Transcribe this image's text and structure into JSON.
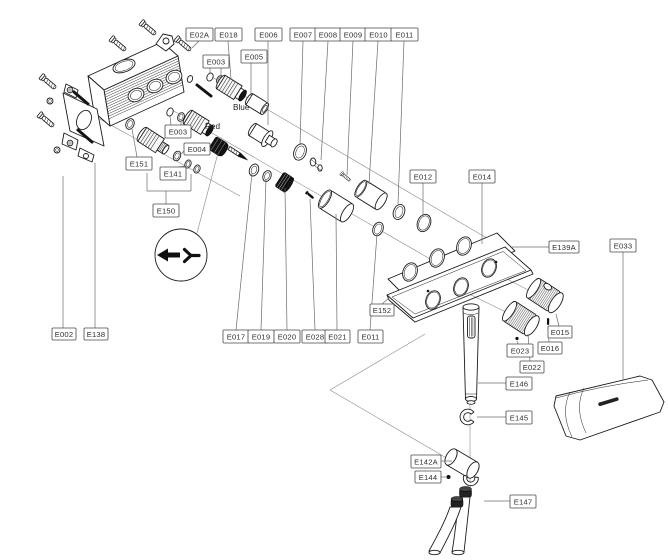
{
  "diagram": {
    "description": "Exploded parts diagram of a thermostatic shower mixer valve assembly",
    "background": "#ffffff",
    "line_color": "#1c1c1c",
    "leader_color": "#6b6b6b",
    "label_border_color": "#4a4a4a",
    "label_text_color": "#2e2e2e",
    "annotations": [
      {
        "text": "Blue",
        "x": 233,
        "y": 110
      },
      {
        "text": "Red",
        "x": 205,
        "y": 129
      }
    ],
    "labels": [
      {
        "text": "E02A",
        "x": 186,
        "y": 28,
        "w": 27,
        "h": 13,
        "leaders": [
          [
            [
              199,
              41
            ],
            [
              192,
              48
            ]
          ]
        ]
      },
      {
        "text": "E018",
        "x": 215,
        "y": 28,
        "w": 27,
        "h": 13,
        "leaders": [
          [
            [
              228,
              41
            ],
            [
              231,
              79
            ]
          ]
        ]
      },
      {
        "text": "E006",
        "x": 255,
        "y": 28,
        "w": 27,
        "h": 13,
        "leaders": [
          [
            [
              268,
              41
            ],
            [
              268,
              125
            ]
          ]
        ]
      },
      {
        "text": "E007",
        "x": 290,
        "y": 28,
        "w": 26,
        "h": 13,
        "leaders": [
          [
            [
              303,
              41
            ],
            [
              300,
              145
            ]
          ]
        ]
      },
      {
        "text": "E008",
        "x": 315,
        "y": 28,
        "w": 26,
        "h": 13,
        "leaders": [
          [
            [
              328,
              41
            ],
            [
              321,
              160
            ]
          ]
        ]
      },
      {
        "text": "E009",
        "x": 340,
        "y": 28,
        "w": 26,
        "h": 13,
        "leaders": [
          [
            [
              353,
              41
            ],
            [
              347,
              175
            ]
          ]
        ]
      },
      {
        "text": "E010",
        "x": 365,
        "y": 28,
        "w": 27,
        "h": 13,
        "leaders": [
          [
            [
              378,
              41
            ],
            [
              369,
              184
            ]
          ]
        ]
      },
      {
        "text": "E011",
        "x": 391,
        "y": 28,
        "w": 27,
        "h": 13,
        "leaders": [
          [
            [
              404,
              41
            ],
            [
              398,
              204
            ]
          ]
        ]
      },
      {
        "text": "E003",
        "x": 203,
        "y": 55,
        "w": 26,
        "h": 13,
        "leaders": [
          [
            [
              210,
              68
            ],
            [
              210,
              74
            ]
          ],
          [
            [
              221,
              68
            ],
            [
              221,
              77
            ]
          ]
        ]
      },
      {
        "text": "E005",
        "x": 241,
        "y": 50,
        "w": 26,
        "h": 13,
        "leaders": [
          [
            [
              251,
              63
            ],
            [
              251,
              97
            ]
          ]
        ]
      },
      {
        "text": "E003",
        "x": 165,
        "y": 125,
        "w": 26,
        "h": 13,
        "leaders": [
          [
            [
              171,
              125
            ],
            [
              170,
              116
            ]
          ],
          [
            [
              181,
              125
            ],
            [
              181,
              121
            ]
          ]
        ]
      },
      {
        "text": "E004",
        "x": 184,
        "y": 143,
        "w": 26,
        "h": 12,
        "leaders": [
          [
            [
              184,
              151
            ],
            [
              180,
              155
            ]
          ]
        ]
      },
      {
        "text": "E151",
        "x": 126,
        "y": 157,
        "w": 26,
        "h": 13,
        "leaders": [
          [
            [
              137,
              157
            ],
            [
              132,
              129
            ]
          ]
        ]
      },
      {
        "text": "E141",
        "x": 160,
        "y": 167,
        "w": 26,
        "h": 13,
        "leaders": [
          [
            [
              178,
              167
            ],
            [
              187,
              166
            ]
          ]
        ]
      },
      {
        "text": "E150",
        "x": 153,
        "y": 204,
        "w": 26,
        "h": 13,
        "leaders": [
          [
            [
              166,
              204
            ],
            [
              166,
              191
            ]
          ],
          [
            [
              147,
              191
            ],
            [
              191,
              191
            ]
          ],
          [
            [
              147,
              191
            ],
            [
              147,
              173
            ]
          ],
          [
            [
              191,
              191
            ],
            [
              191,
              174
            ]
          ]
        ]
      },
      {
        "text": "E002",
        "x": 52,
        "y": 328,
        "w": 24,
        "h": 12,
        "leaders": [
          [
            [
              63,
              328
            ],
            [
              63,
              176
            ]
          ]
        ]
      },
      {
        "text": "E138",
        "x": 84,
        "y": 328,
        "w": 24,
        "h": 12,
        "leaders": [
          [
            [
              95,
              328
            ],
            [
              95,
              163
            ]
          ]
        ]
      },
      {
        "text": "E017",
        "x": 223,
        "y": 330,
        "w": 26,
        "h": 13,
        "leaders": [
          [
            [
              236,
              330
            ],
            [
              252,
              173
            ]
          ]
        ]
      },
      {
        "text": "E019",
        "x": 248,
        "y": 330,
        "w": 26,
        "h": 13,
        "leaders": [
          [
            [
              261,
              330
            ],
            [
              266,
              179
            ]
          ]
        ]
      },
      {
        "text": "E020",
        "x": 274,
        "y": 330,
        "w": 26,
        "h": 13,
        "leaders": [
          [
            [
              287,
              330
            ],
            [
              285,
              188
            ]
          ]
        ]
      },
      {
        "text": "E028",
        "x": 302,
        "y": 330,
        "w": 26,
        "h": 13,
        "leaders": [
          [
            [
              315,
              330
            ],
            [
              310,
              199
            ]
          ]
        ]
      },
      {
        "text": "E021",
        "x": 325,
        "y": 330,
        "w": 25,
        "h": 13,
        "leaders": [
          [
            [
              337,
              330
            ],
            [
              336,
              214
            ]
          ]
        ]
      },
      {
        "text": "E011",
        "x": 358,
        "y": 330,
        "w": 25,
        "h": 13,
        "leaders": [
          [
            [
              370,
              330
            ],
            [
              377,
              234
            ]
          ]
        ]
      },
      {
        "text": "E152",
        "x": 370,
        "y": 304,
        "w": 24,
        "h": 12,
        "leaders": [
          [
            [
              382,
              304
            ],
            [
              390,
              297
            ]
          ]
        ]
      },
      {
        "text": "E012",
        "x": 410,
        "y": 170,
        "w": 26,
        "h": 13,
        "leaders": [
          [
            [
              423,
              183
            ],
            [
              423,
              216
            ]
          ]
        ]
      },
      {
        "text": "E014",
        "x": 469,
        "y": 170,
        "w": 26,
        "h": 13,
        "leaders": [
          [
            [
              482,
              183
            ],
            [
              482,
              244
            ]
          ]
        ]
      },
      {
        "text": "E139A",
        "x": 549,
        "y": 241,
        "w": 30,
        "h": 12,
        "leaders": [
          [
            [
              549,
              247
            ],
            [
              510,
              247
            ]
          ]
        ]
      },
      {
        "text": "E033",
        "x": 610,
        "y": 239,
        "w": 26,
        "h": 13,
        "leaders": [
          [
            [
              623,
              252
            ],
            [
              623,
              380
            ]
          ]
        ]
      },
      {
        "text": "E015",
        "x": 548,
        "y": 326,
        "w": 24,
        "h": 12,
        "leaders": [
          [
            [
              559,
              326
            ],
            [
              556,
              314
            ]
          ]
        ]
      },
      {
        "text": "E016",
        "x": 538,
        "y": 342,
        "w": 24,
        "h": 12,
        "leaders": [
          [
            [
              549,
              342
            ],
            [
              548,
              327
            ]
          ]
        ]
      },
      {
        "text": "E023",
        "x": 507,
        "y": 344,
        "w": 26,
        "h": 13,
        "leaders": [
          [
            [
              518,
              344
            ],
            [
              517,
              341
            ]
          ]
        ]
      },
      {
        "text": "E022",
        "x": 520,
        "y": 361,
        "w": 24,
        "h": 12,
        "leaders": [
          [
            [
              530,
              361
            ],
            [
              528,
              334
            ]
          ]
        ]
      },
      {
        "text": "E146",
        "x": 506,
        "y": 377,
        "w": 26,
        "h": 13,
        "leaders": [
          [
            [
              506,
              383
            ],
            [
              478,
              383
            ]
          ]
        ]
      },
      {
        "text": "E145",
        "x": 506,
        "y": 411,
        "w": 26,
        "h": 13,
        "leaders": [
          [
            [
              506,
              417
            ],
            [
              477,
              417
            ]
          ]
        ]
      },
      {
        "text": "E142A",
        "x": 411,
        "y": 455,
        "w": 30,
        "h": 13,
        "leaders": [
          [
            [
              441,
              461
            ],
            [
              452,
              461
            ]
          ]
        ]
      },
      {
        "text": "E144",
        "x": 415,
        "y": 471,
        "w": 26,
        "h": 12,
        "leaders": [
          [
            [
              441,
              477
            ],
            [
              446,
              477
            ]
          ]
        ]
      },
      {
        "text": "E147",
        "x": 510,
        "y": 495,
        "w": 26,
        "h": 13,
        "leaders": [
          [
            [
              510,
              501
            ],
            [
              484,
              501
            ]
          ]
        ]
      }
    ]
  }
}
